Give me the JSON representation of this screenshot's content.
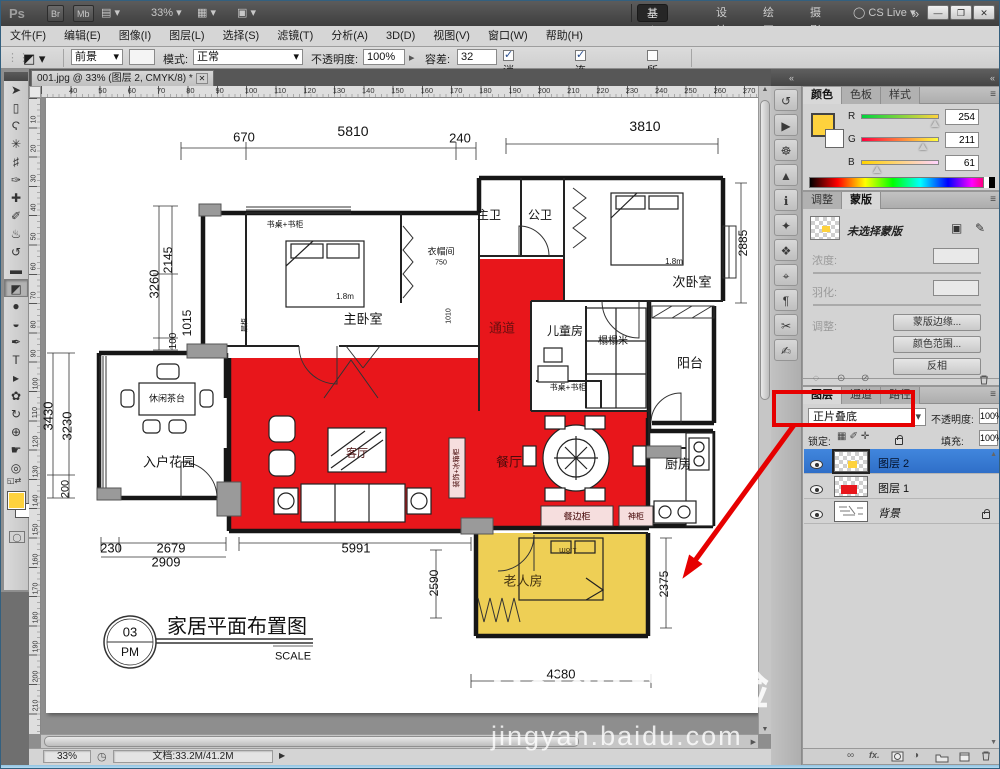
{
  "titlebar": {
    "logo": "Ps",
    "bridge": "Br",
    "minibridge": "Mb",
    "arrange_glyph": "▤",
    "zoom_level": "33%",
    "extras_glyph": "▦",
    "screenmode_glyph": "▣",
    "workspaces": [
      {
        "label": "基本功能",
        "active": true
      },
      {
        "label": "设计"
      },
      {
        "label": "绘画"
      },
      {
        "label": "摄影"
      }
    ],
    "more": "»",
    "cslive": "CS Live",
    "min": "—",
    "restore": "❐",
    "close": "✕"
  },
  "menubar": {
    "items": [
      "文件(F)",
      "编辑(E)",
      "图像(I)",
      "图层(L)",
      "选择(S)",
      "滤镜(T)",
      "分析(A)",
      "3D(D)",
      "视图(V)",
      "窗口(W)",
      "帮助(H)"
    ]
  },
  "options": {
    "tool_glyph": "◩",
    "fg_label": "前景",
    "mode_label": "模式:",
    "mode_value": "正常",
    "opacity_label": "不透明度:",
    "opacity_value": "100%",
    "tolerance_label": "容差:",
    "tolerance_value": "32",
    "checks": [
      {
        "label": "消除锯齿",
        "checked": true
      },
      {
        "label": "连续的",
        "checked": true
      },
      {
        "label": "所有图层",
        "checked": false
      }
    ]
  },
  "tools": [
    {
      "name": "move-tool",
      "glyph": "➤"
    },
    {
      "name": "marquee-tool",
      "glyph": "▯"
    },
    {
      "name": "lasso-tool",
      "glyph": "Ϛ"
    },
    {
      "name": "magic-wand-tool",
      "glyph": "✳"
    },
    {
      "name": "crop-tool",
      "glyph": "♯"
    },
    {
      "name": "eyedropper-tool",
      "glyph": "✑"
    },
    {
      "name": "healing-brush-tool",
      "glyph": "✚"
    },
    {
      "name": "brush-tool",
      "glyph": "✐"
    },
    {
      "name": "clone-stamp-tool",
      "glyph": "♨"
    },
    {
      "name": "history-brush-tool",
      "glyph": "↺"
    },
    {
      "name": "eraser-tool",
      "glyph": "▬"
    },
    {
      "name": "paint-bucket-tool",
      "glyph": "◩",
      "selected": true
    },
    {
      "name": "blur-tool",
      "glyph": "●"
    },
    {
      "name": "dodge-tool",
      "glyph": "◒"
    },
    {
      "name": "pen-tool",
      "glyph": "✒"
    },
    {
      "name": "type-tool",
      "glyph": "T"
    },
    {
      "name": "path-selection-tool",
      "glyph": "▸"
    },
    {
      "name": "shape-tool",
      "glyph": "✿"
    },
    {
      "name": "3d-rotate-tool",
      "glyph": "↻"
    },
    {
      "name": "3d-orbit-tool",
      "glyph": "⊕"
    },
    {
      "name": "hand-tool",
      "glyph": "☛"
    },
    {
      "name": "zoom-tool",
      "glyph": "◎"
    }
  ],
  "foreground_color": "#fed23d",
  "doc": {
    "tab": "001.jpg @ 33% (图层 2, CMYK/8) *",
    "tab_close": "✕",
    "ruler_top": [
      "40",
      "50",
      "60",
      "70",
      "80",
      "90",
      "100",
      "110",
      "120",
      "130",
      "140",
      "150",
      "160",
      "170",
      "180",
      "190",
      "200",
      "210",
      "220",
      "230",
      "240",
      "250",
      "260",
      "270"
    ],
    "ruler_left": [
      "10",
      "20",
      "30",
      "40",
      "50",
      "60",
      "70",
      "80",
      "90",
      "100",
      "110",
      "120",
      "130",
      "140",
      "150",
      "160",
      "170",
      "180",
      "190",
      "200",
      "210"
    ],
    "status_zoom": "33%",
    "status_doc": "文档:33.2M/41.2M",
    "status_clock": "◷",
    "status_arrow": "▶"
  },
  "dock_icons": [
    {
      "name": "history-panel-icon",
      "glyph": "↺"
    },
    {
      "name": "actions-panel-icon",
      "glyph": "▶"
    },
    {
      "name": "navigator-panel-icon",
      "glyph": "☸"
    },
    {
      "name": "histogram-panel-icon",
      "glyph": "▲"
    },
    {
      "name": "info-panel-icon",
      "glyph": "ℹ"
    },
    {
      "name": "adjustments-panel-icon",
      "glyph": "✦"
    },
    {
      "name": "styles-panel-icon",
      "glyph": "❖"
    },
    {
      "name": "clone-source-panel-icon",
      "glyph": "⌖"
    },
    {
      "name": "paragraph-panel-icon",
      "glyph": "¶"
    },
    {
      "name": "tool-presets-panel-icon",
      "glyph": "✂"
    },
    {
      "name": "notes-panel-icon",
      "glyph": "✍"
    }
  ],
  "color_panel": {
    "tabs": [
      {
        "label": "颜色",
        "active": true
      },
      {
        "label": "色板"
      },
      {
        "label": "样式"
      }
    ],
    "menu_glyph": "≡",
    "channels": [
      {
        "label": "R",
        "value": "254"
      },
      {
        "label": "G",
        "value": "211"
      },
      {
        "label": "B",
        "value": "61"
      }
    ]
  },
  "masks_panel": {
    "tabs": [
      {
        "label": "调整"
      },
      {
        "label": "蒙版",
        "active": true
      }
    ],
    "menu_glyph": "≡",
    "none_selected": "未选择蒙版",
    "pixel_mask_glyph": "▣",
    "vector_mask_glyph": "✎",
    "density_label": "浓度:",
    "feather_label": "羽化:",
    "refine_label": "调整:",
    "buttons": [
      "蒙版边缘...",
      "颜色范围...",
      "反相"
    ],
    "footer": [
      "◌",
      "⊙",
      "⊘"
    ]
  },
  "layers_panel": {
    "tabs": [
      {
        "label": "图层",
        "active": true
      },
      {
        "label": "通道"
      },
      {
        "label": "路径"
      }
    ],
    "menu_glyph": "≡",
    "blend_mode": "正片叠底",
    "opacity_label": "不透明度:",
    "opacity_value": "100%",
    "lock_label": "锁定:",
    "lock_glyphs": [
      "▦",
      "✐",
      "✛"
    ],
    "fill_label": "填充:",
    "fill_value": "100%",
    "rows": [
      {
        "name": "图层 2"
      },
      {
        "name": "图层 1"
      },
      {
        "name": "背景"
      }
    ],
    "fx_label": "fx.",
    "link_glyph": "∞",
    "adjust_glyph": "◑"
  },
  "watermark": {
    "brand": "Baidu",
    "brand2": "经验",
    "url": "jingyan.baidu.com"
  },
  "plan": {
    "red": "#e8161b",
    "yellow": "#eecf55",
    "cab": "#f6dede",
    "labels": [
      {
        "t": "670",
        "x": 203,
        "y": 39,
        "s": 13
      },
      {
        "t": "5810",
        "x": 312,
        "y": 33,
        "s": 14
      },
      {
        "t": "240",
        "x": 419,
        "y": 40,
        "s": 13
      },
      {
        "t": "3810",
        "x": 604,
        "y": 28,
        "s": 14
      },
      {
        "t": "3260",
        "x": 113,
        "y": 186,
        "s": 13,
        "r": -90
      },
      {
        "t": "2145",
        "x": 127,
        "y": 162,
        "s": 12,
        "r": -90
      },
      {
        "t": "1015",
        "x": 146,
        "y": 225,
        "s": 12,
        "r": -90
      },
      {
        "t": "100",
        "x": 133,
        "y": 243,
        "s": 10,
        "r": -90
      },
      {
        "t": "3430",
        "x": 7,
        "y": 318,
        "s": 13,
        "r": -90
      },
      {
        "t": "3230",
        "x": 26,
        "y": 328,
        "s": 13,
        "r": -90
      },
      {
        "t": "200",
        "x": 25,
        "y": 391,
        "s": 11,
        "r": -90
      },
      {
        "t": "230",
        "x": 70,
        "y": 450,
        "s": 13
      },
      {
        "t": "2679",
        "x": 130,
        "y": 450,
        "s": 13
      },
      {
        "t": "2909",
        "x": 125,
        "y": 464,
        "s": 13
      },
      {
        "t": "5991",
        "x": 315,
        "y": 450,
        "s": 13
      },
      {
        "t": "2590",
        "x": 393,
        "y": 485,
        "s": 12,
        "r": -90
      },
      {
        "t": "2375",
        "x": 623,
        "y": 486,
        "s": 12,
        "r": -90
      },
      {
        "t": "4380",
        "x": 520,
        "y": 576,
        "s": 13
      },
      {
        "t": "2885",
        "x": 702,
        "y": 145,
        "s": 12,
        "r": -90
      },
      {
        "t": "1010",
        "x": 408,
        "y": 218,
        "s": 7,
        "r": -90
      },
      {
        "t": "书桌+书柜",
        "x": 244,
        "y": 127,
        "s": 8
      },
      {
        "t": "主卧室",
        "x": 322,
        "y": 221,
        "s": 13
      },
      {
        "t": "1.8m",
        "x": 304,
        "y": 199,
        "s": 8
      },
      {
        "t": "衣帽间",
        "x": 400,
        "y": 154,
        "s": 9
      },
      {
        "t": "750",
        "x": 400,
        "y": 165,
        "s": 7
      },
      {
        "t": "层柜",
        "x": 204,
        "y": 227,
        "s": 7,
        "r": -90
      },
      {
        "t": "主卫",
        "x": 448,
        "y": 117,
        "s": 12
      },
      {
        "t": "公卫",
        "x": 499,
        "y": 117,
        "s": 12
      },
      {
        "t": "次卧室",
        "x": 651,
        "y": 184,
        "s": 13
      },
      {
        "t": "1.8m",
        "x": 633,
        "y": 164,
        "s": 8
      },
      {
        "t": "通道",
        "x": 461,
        "y": 230,
        "s": 13,
        "c": "#6b0f0f"
      },
      {
        "t": "儿童房",
        "x": 524,
        "y": 233,
        "s": 12
      },
      {
        "t": "榻榻米",
        "x": 572,
        "y": 244,
        "s": 10
      },
      {
        "t": "书桌+书柜",
        "x": 527,
        "y": 290,
        "s": 8
      },
      {
        "t": "阳台",
        "x": 649,
        "y": 265,
        "s": 13
      },
      {
        "t": "客厅",
        "x": 316,
        "y": 356,
        "s": 11,
        "c": "#4a0b0b"
      },
      {
        "t": "餐厅",
        "x": 468,
        "y": 364,
        "s": 13,
        "c": "#4a0b0b"
      },
      {
        "t": "厨房",
        "x": 637,
        "y": 366,
        "s": 13
      },
      {
        "t": "休闲茶台",
        "x": 126,
        "y": 301,
        "s": 9
      },
      {
        "t": "入户花园",
        "x": 128,
        "y": 364,
        "s": 13
      },
      {
        "t": "老人房",
        "x": 482,
        "y": 483,
        "s": 13,
        "c": "#443311"
      },
      {
        "t": "1.8m",
        "x": 527,
        "y": 452,
        "s": 8,
        "r": 180,
        "c": "#443311"
      },
      {
        "t": "餐边柜",
        "x": 536,
        "y": 419,
        "s": 9,
        "c": "#400000"
      },
      {
        "t": "神柜",
        "x": 595,
        "y": 419,
        "s": 8,
        "c": "#400000"
      },
      {
        "t": "装饰+冰箱柜",
        "x": 416,
        "y": 370,
        "s": 7,
        "r": -90,
        "c": "#400000"
      },
      {
        "t": "03",
        "x": 89,
        "y": 534,
        "s": 13
      },
      {
        "t": "PM",
        "x": 89,
        "y": 554,
        "s": 12
      },
      {
        "t": "家居平面布置图",
        "x": 196,
        "y": 529,
        "s": 20
      },
      {
        "t": "SCALE",
        "x": 252,
        "y": 559,
        "s": 11
      }
    ]
  }
}
